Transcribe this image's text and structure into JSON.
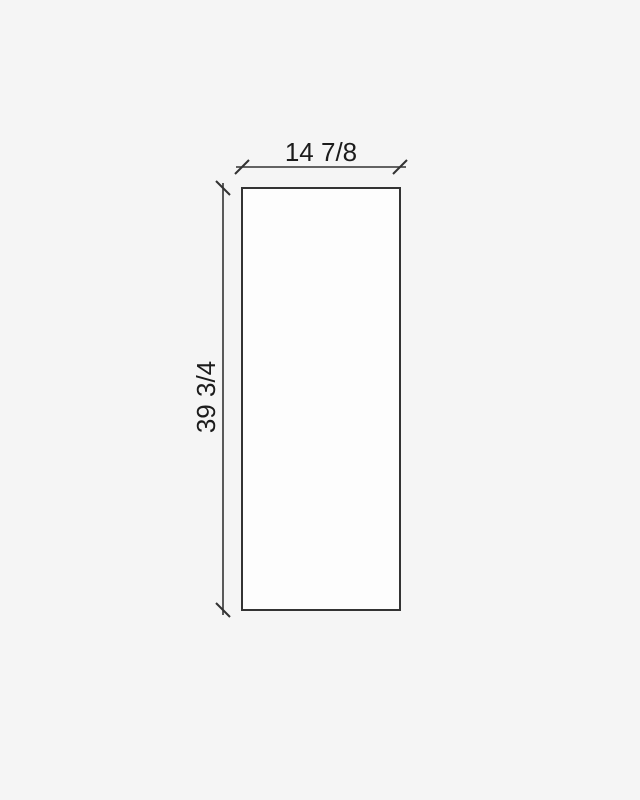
{
  "drawing": {
    "width_label": "14 7/8",
    "height_label": "39 3/4"
  },
  "colors": {
    "background": "#f5f5f5",
    "shape_fill": "#fdfdfd",
    "line": "#333333",
    "text": "#1c1c1c"
  }
}
